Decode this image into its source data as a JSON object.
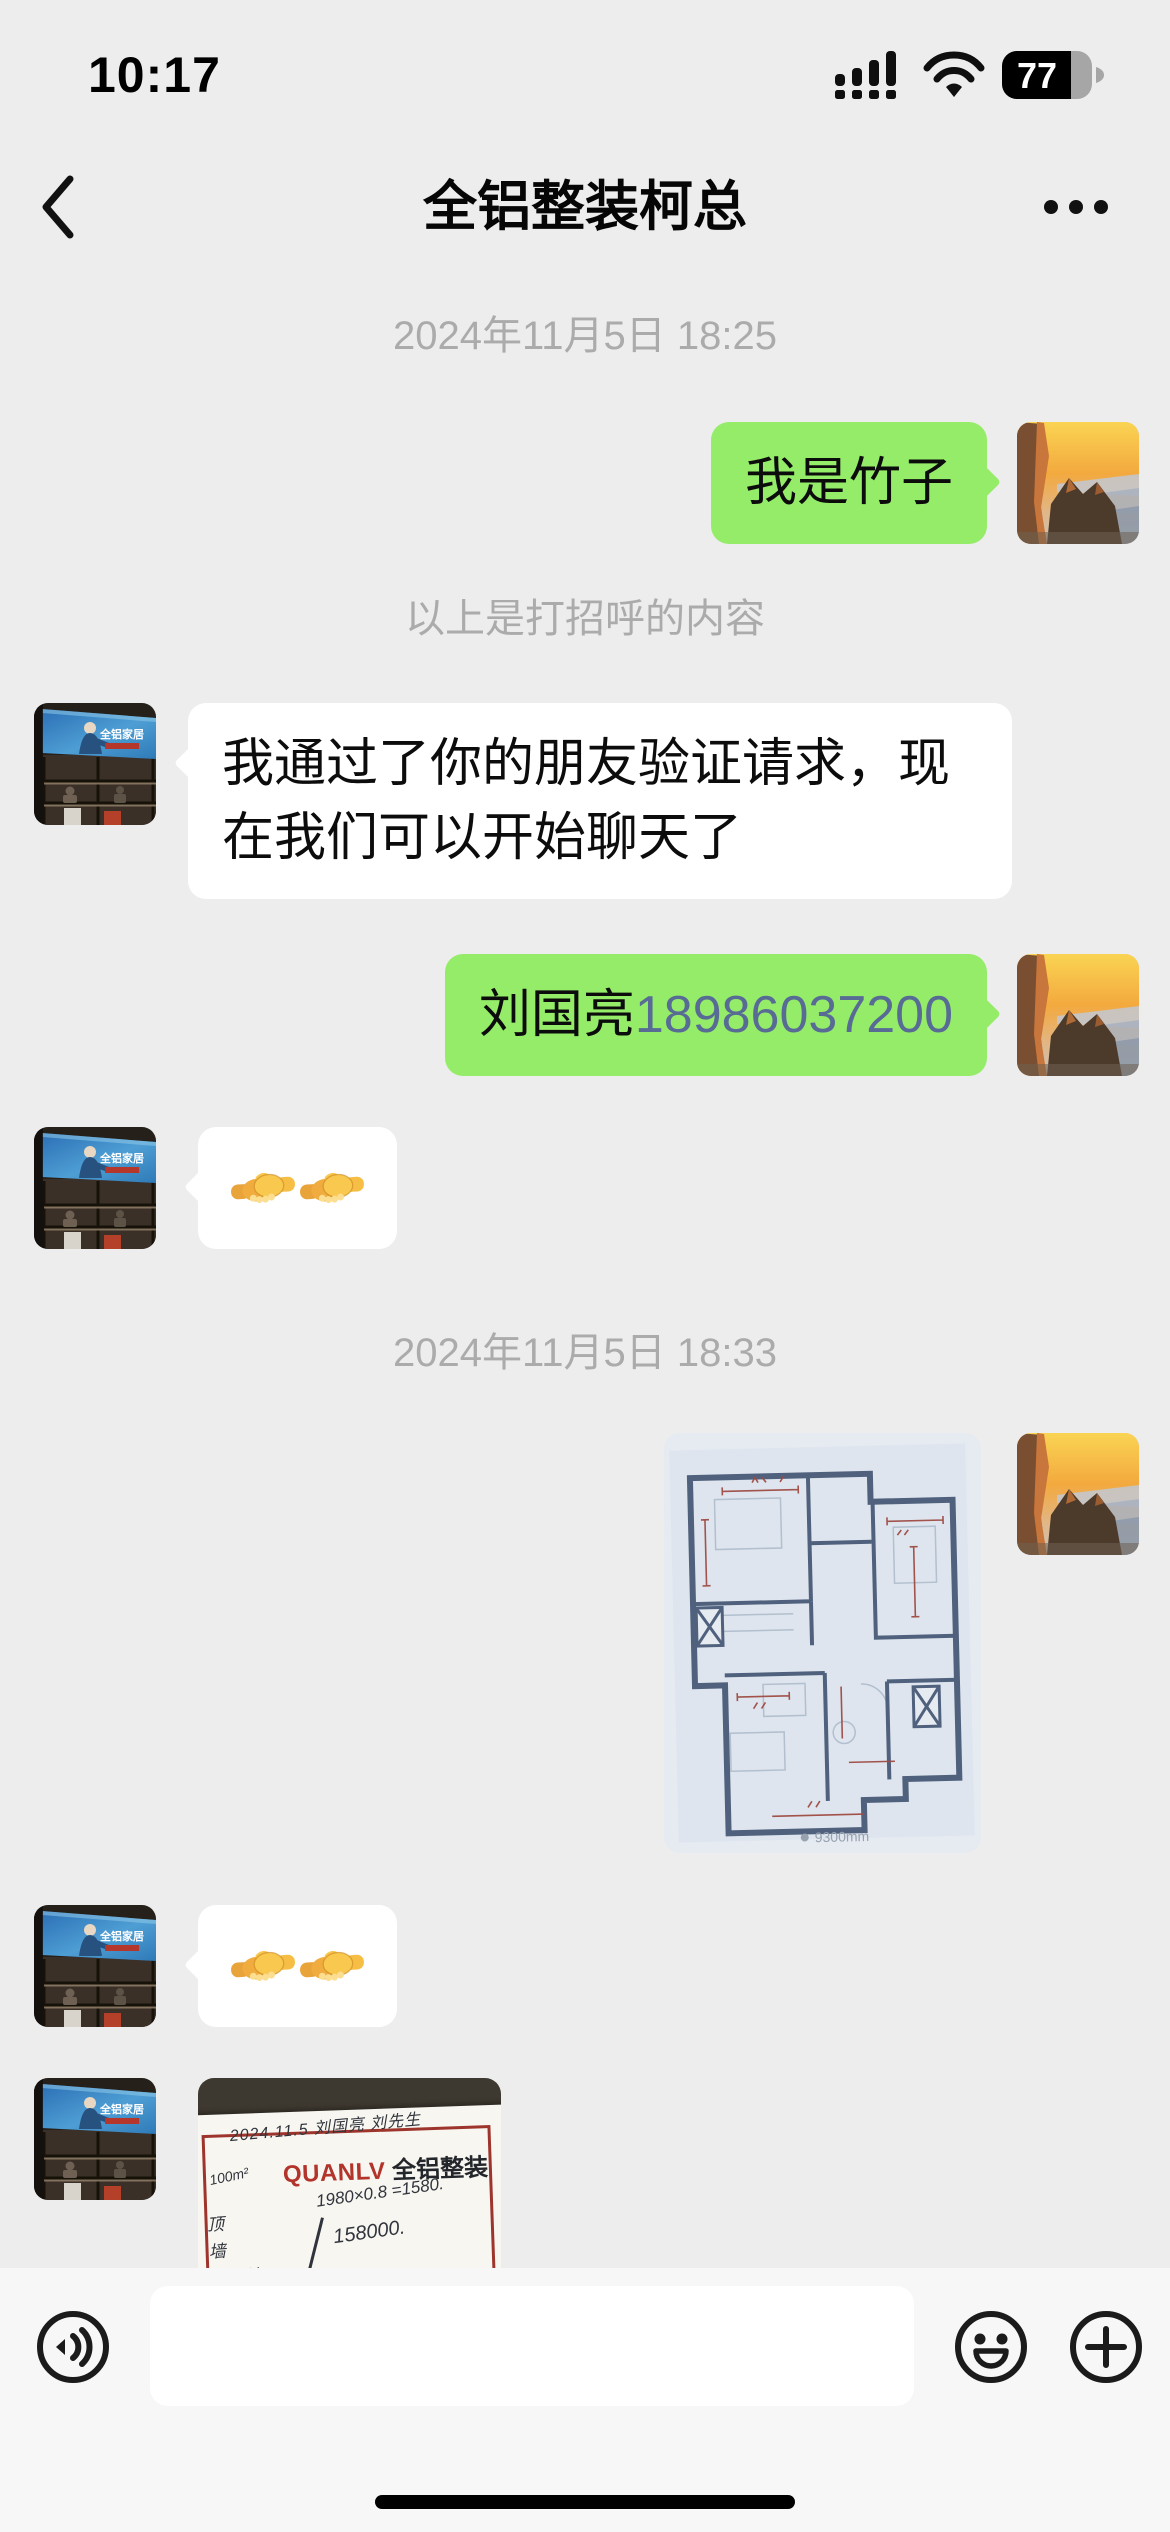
{
  "status_bar": {
    "time": "10:17",
    "battery_percent": "77"
  },
  "nav_bar": {
    "title": "全铝整装柯总"
  },
  "avatars": {
    "self": "mountain-sunset-photo",
    "contact": "showroom-shelf-photo",
    "contact_board_text": "全铝家居"
  },
  "chat": {
    "date_header_1": "2024年11月5日 18:25",
    "greeting_note": "以上是打招呼的内容",
    "date_header_2": "2024年11月5日 18:33",
    "messages": [
      {
        "direction": "sent",
        "type": "text",
        "text": "我是竹子"
      },
      {
        "direction": "received",
        "type": "text",
        "text": "我通过了你的朋友验证请求，现在我们可以开始聊天了"
      },
      {
        "direction": "sent",
        "type": "text",
        "name_part": "刘国亮",
        "phone_part": "18986037200"
      },
      {
        "direction": "received",
        "type": "emoji",
        "text": "🤝🤝"
      },
      {
        "direction": "sent",
        "type": "image",
        "image": "hand-drawn-floor-plan-photo",
        "watermark": "9300mm"
      },
      {
        "direction": "received",
        "type": "emoji",
        "text": "🤝🤝"
      },
      {
        "direction": "received",
        "type": "image",
        "image": "handwritten-price-note-photo"
      }
    ],
    "receipt_note": {
      "date_line": "2024.11.5 刘国亮 刘先生",
      "area": "100m²",
      "brand_en": "QUANLV",
      "brand_cn": "全铝整装",
      "calc_line": "1980×0.8 =1580.",
      "total": "158000.",
      "items": [
        "顶",
        "墙",
        "背景墙",
        "线条",
        "造型"
      ]
    }
  },
  "input_bar": {
    "value": ""
  },
  "colors": {
    "background": "#EDEDED",
    "sent_bubble": "#95EC69",
    "received_bubble": "#FFFFFF",
    "link": "#576B95",
    "input_bar": "#F7F7F7"
  }
}
